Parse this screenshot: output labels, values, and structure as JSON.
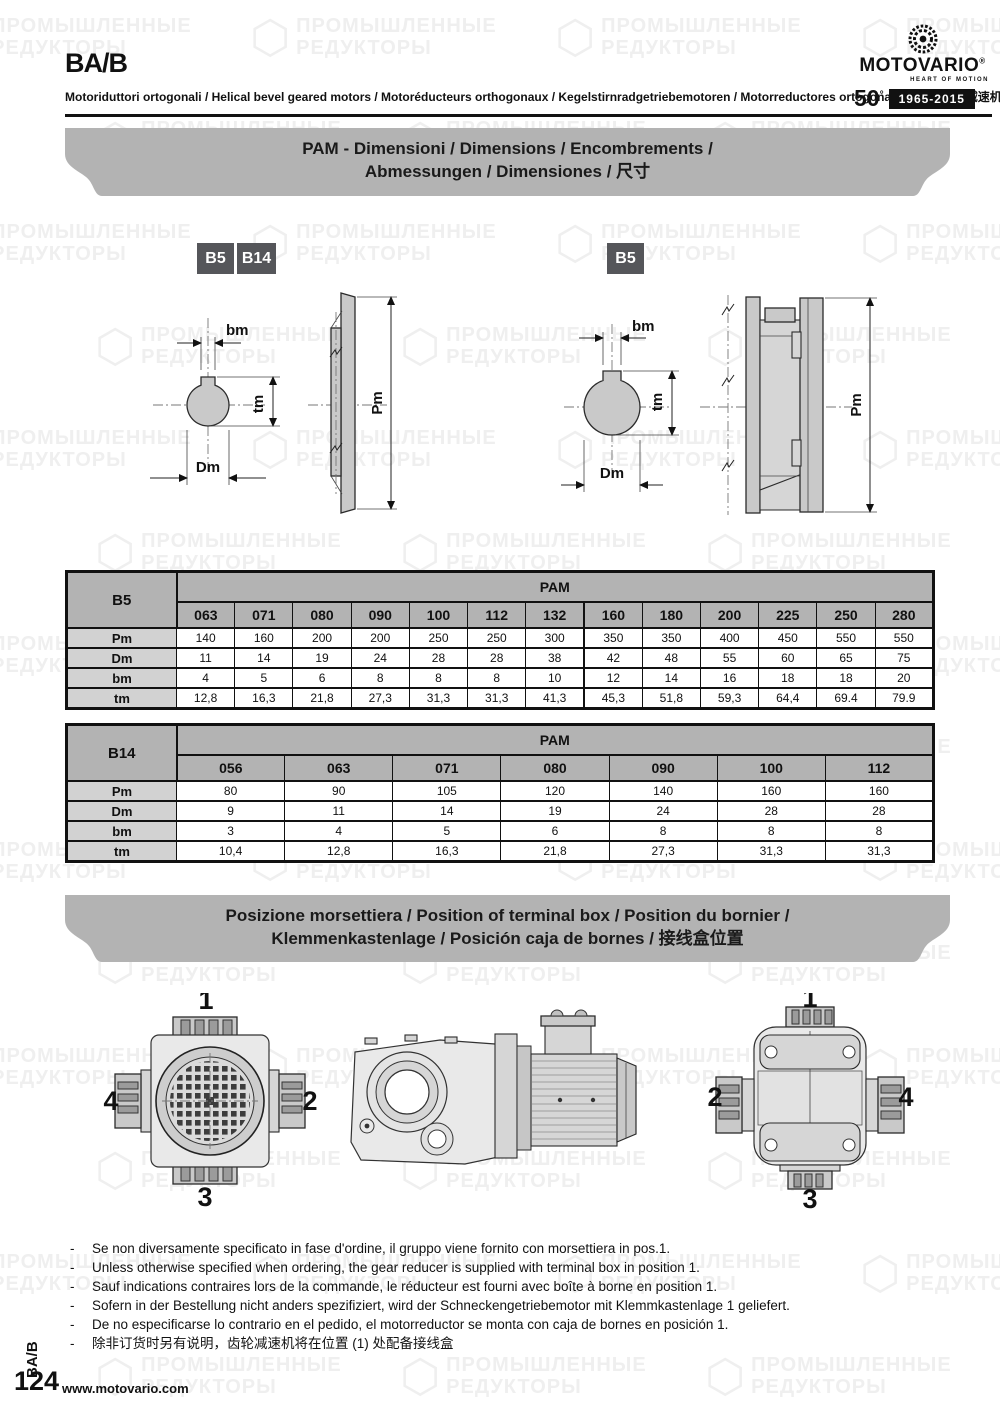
{
  "header": {
    "title": "BA/B",
    "subtitle": "Motoriduttori ortogonali / Helical bevel geared motors / Motoréducteurs orthogonaux / Kegelstirnradgetriebemotoren / Motorreductores ortogonales / 斜伞齿轮减速机",
    "logo": {
      "brand": "MOTOVARIO",
      "registered": "®",
      "tagline": "HEART OF MOTION",
      "anniversary_number": "50",
      "anniversary_degree": "°",
      "anniversary_years": "1965-2015"
    }
  },
  "watermark": {
    "line1": "ПРОМЫШЛЕННЫЕ",
    "line2": "РЕДУКТОРЫ",
    "hex_glyph": "⬡"
  },
  "banners": {
    "pam": {
      "line1": "PAM - Dimensioni / Dimensions / Encombrements /",
      "line2": "Abmessungen / Dimensiones / 尺寸"
    },
    "terminal": {
      "line1": "Posizione morsettiera / Position of terminal box / Position du bornier /",
      "line2": "Klemmenkastenlage / Posición caja de bornes / 接线盒位置"
    }
  },
  "diagrams": {
    "badges_left": [
      "B5",
      "B14"
    ],
    "badge_right": "B5",
    "labels": {
      "bm": "bm",
      "tm": "tm",
      "dm": "Dm",
      "pm": "Pm"
    }
  },
  "tables": {
    "b5": {
      "row_header": "B5",
      "group_header": "PAM",
      "columns": [
        "063",
        "071",
        "080",
        "090",
        "100",
        "112",
        "132",
        "160",
        "180",
        "200",
        "225",
        "250",
        "280"
      ],
      "rows": [
        {
          "label": "Pm",
          "values": [
            "140",
            "160",
            "200",
            "200",
            "250",
            "250",
            "300",
            "350",
            "350",
            "400",
            "450",
            "550",
            "550"
          ]
        },
        {
          "label": "Dm",
          "values": [
            "11",
            "14",
            "19",
            "24",
            "28",
            "28",
            "38",
            "42",
            "48",
            "55",
            "60",
            "65",
            "75"
          ]
        },
        {
          "label": "bm",
          "values": [
            "4",
            "5",
            "6",
            "8",
            "8",
            "8",
            "10",
            "12",
            "14",
            "16",
            "18",
            "18",
            "20"
          ]
        },
        {
          "label": "tm",
          "values": [
            "12,8",
            "16,3",
            "21,8",
            "27,3",
            "31,3",
            "31,3",
            "41,3",
            "45,3",
            "51,8",
            "59,3",
            "64,4",
            "69.4",
            "79.9"
          ]
        }
      ]
    },
    "b14": {
      "row_header": "B14",
      "group_header": "PAM",
      "columns": [
        "056",
        "063",
        "071",
        "080",
        "090",
        "100",
        "112"
      ],
      "rows": [
        {
          "label": "Pm",
          "values": [
            "80",
            "90",
            "105",
            "120",
            "140",
            "160",
            "160"
          ]
        },
        {
          "label": "Dm",
          "values": [
            "9",
            "11",
            "14",
            "19",
            "24",
            "28",
            "28"
          ]
        },
        {
          "label": "bm",
          "values": [
            "3",
            "4",
            "5",
            "6",
            "8",
            "8",
            "8"
          ]
        },
        {
          "label": "tm",
          "values": [
            "10,4",
            "12,8",
            "16,3",
            "21,8",
            "27,3",
            "31,3",
            "31,3"
          ]
        }
      ]
    }
  },
  "positions": {
    "rear_view": {
      "top": "1",
      "right": "2",
      "bottom": "3",
      "left": "4"
    },
    "front_view": {
      "top": "1",
      "left": "2",
      "bottom": "3",
      "right": "4"
    }
  },
  "notes": [
    "Se non diversamente specificato in fase d'ordine, il gruppo viene fornito con morsettiera in pos.1.",
    "Unless otherwise specified when ordering, the gear reducer is supplied with terminal box in position 1.",
    "Sauf indications contraires lors de la commande, le réducteur est fourni avec boîte à borne en position 1.",
    "Sofern in der Bestellung nicht anders spezifiziert, wird der Schneckengetriebemotor mit Klemmkastenlage 1 geliefert.",
    "De no especificarse lo contrario en el pedido, el motorreductor se monta con caja de bornes en posición 1.",
    "除非订货时另有说明，齿轮减速机将在位置 (1) 处配备接线盒"
  ],
  "note_dash": "-",
  "footer": {
    "side_label": "BA/B",
    "page_number": "124",
    "website": "www.motovario.com"
  }
}
